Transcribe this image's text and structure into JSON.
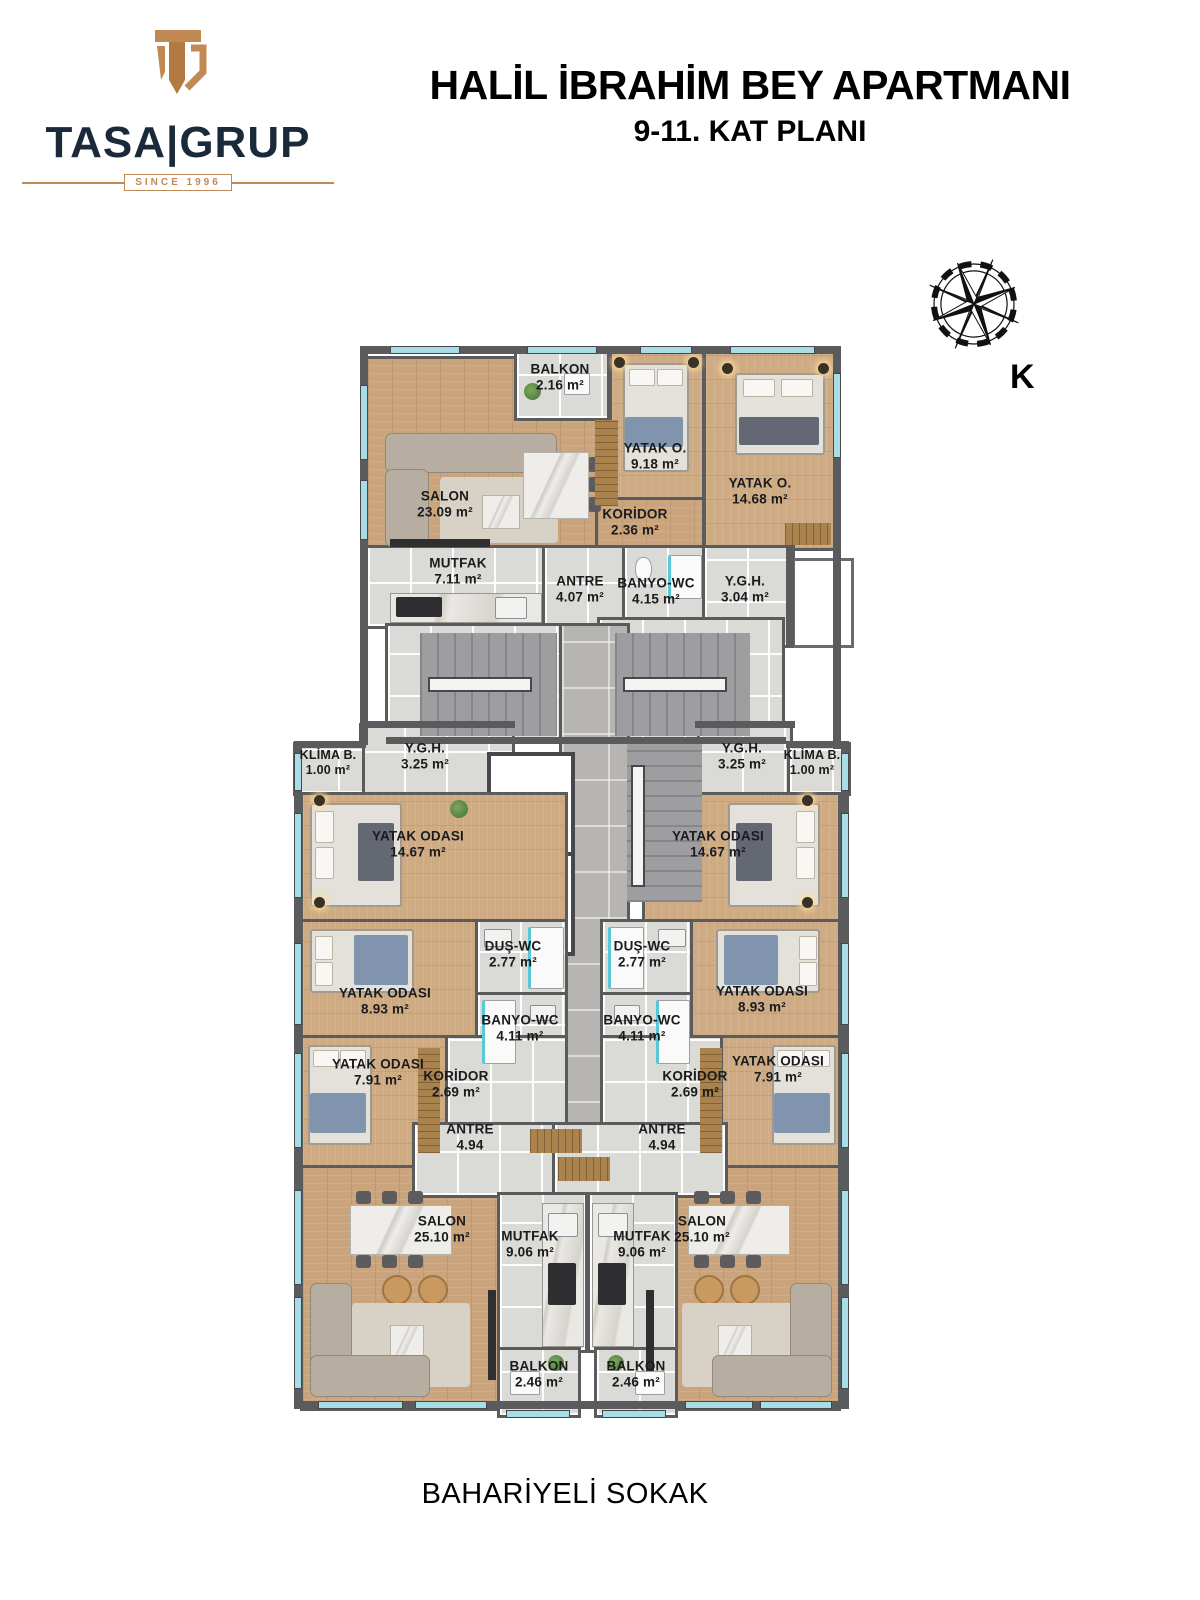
{
  "header": {
    "logo_text": "TASA|GRUP",
    "logo_since": "SINCE 1996",
    "title": "HALİL İBRAHİM BEY APARTMANI",
    "subtitle": "9-11. KAT PLANI"
  },
  "compass": {
    "north_label": "K"
  },
  "street_label": "BAHARİYELİ SOKAK",
  "colors": {
    "brand_gold": "#C18A54",
    "brand_navy": "#1B2A3A",
    "wood_floor": "#C9A47D",
    "tile_floor": "#DADAD6",
    "wall": "#5A5B5D",
    "window_glass": "#A8DDE8"
  },
  "rooms": {
    "balkon_top": {
      "name": "BALKON",
      "area": "2.16 m²"
    },
    "salon_top": {
      "name": "SALON",
      "area": "23.09 m²"
    },
    "yatak_o_918": {
      "name": "YATAK O.",
      "area": "9.18 m²"
    },
    "yatak_o_1468": {
      "name": "YATAK O.",
      "area": "14.68 m²"
    },
    "koridor_236": {
      "name": "KORİDOR",
      "area": "2.36 m²"
    },
    "mutfak_711": {
      "name": "MUTFAK",
      "area": "7.11 m²"
    },
    "antre_407": {
      "name": "ANTRE",
      "area": "4.07 m²"
    },
    "banyo_wc_415": {
      "name": "BANYO-WC",
      "area": "4.15 m²"
    },
    "ygh_304": {
      "name": "Y.G.H.",
      "area": "3.04 m²"
    },
    "klima_left": {
      "name": "KLİMA B.",
      "area": "1.00 m²"
    },
    "klima_right": {
      "name": "KLİMA B.",
      "area": "1.00 m²"
    },
    "ygh_325_left": {
      "name": "Y.G.H.",
      "area": "3.25 m²"
    },
    "ygh_325_right": {
      "name": "Y.G.H.",
      "area": "3.25 m²"
    },
    "yatak_1467_left": {
      "name": "YATAK ODASI",
      "area": "14.67 m²"
    },
    "yatak_1467_right": {
      "name": "YATAK ODASI",
      "area": "14.67 m²"
    },
    "dus_wc_left": {
      "name": "DUŞ-WC",
      "area": "2.77 m²"
    },
    "dus_wc_right": {
      "name": "DUŞ-WC",
      "area": "2.77 m²"
    },
    "yatak_893_left": {
      "name": "YATAK ODASI",
      "area": "8.93 m²"
    },
    "yatak_893_right": {
      "name": "YATAK ODASI",
      "area": "8.93 m²"
    },
    "banyo_411_left": {
      "name": "BANYO-WC",
      "area": "4.11 m²"
    },
    "banyo_411_right": {
      "name": "BANYO-WC",
      "area": "4.11 m²"
    },
    "yatak_791_left": {
      "name": "YATAK ODASI",
      "area": "7.91 m²"
    },
    "yatak_791_right": {
      "name": "YATAK ODASI",
      "area": "7.91 m²"
    },
    "koridor_269_left": {
      "name": "KORİDOR",
      "area": "2.69 m²"
    },
    "koridor_269_right": {
      "name": "KORİDOR",
      "area": "2.69 m²"
    },
    "antre_494_left": {
      "name": "ANTRE",
      "area": "4.94"
    },
    "antre_494_right": {
      "name": "ANTRE",
      "area": "4.94"
    },
    "salon_2510_left": {
      "name": "SALON",
      "area": "25.10 m²"
    },
    "salon_2510_right": {
      "name": "SALON",
      "area": "25.10 m²"
    },
    "mutfak_906_left": {
      "name": "MUTFAK",
      "area": "9.06 m²"
    },
    "mutfak_906_right": {
      "name": "MUTFAK",
      "area": "9.06 m²"
    },
    "balkon_246_left": {
      "name": "BALKON",
      "area": "2.46 m²"
    },
    "balkon_246_right": {
      "name": "BALKON",
      "area": "2.46 m²"
    }
  }
}
